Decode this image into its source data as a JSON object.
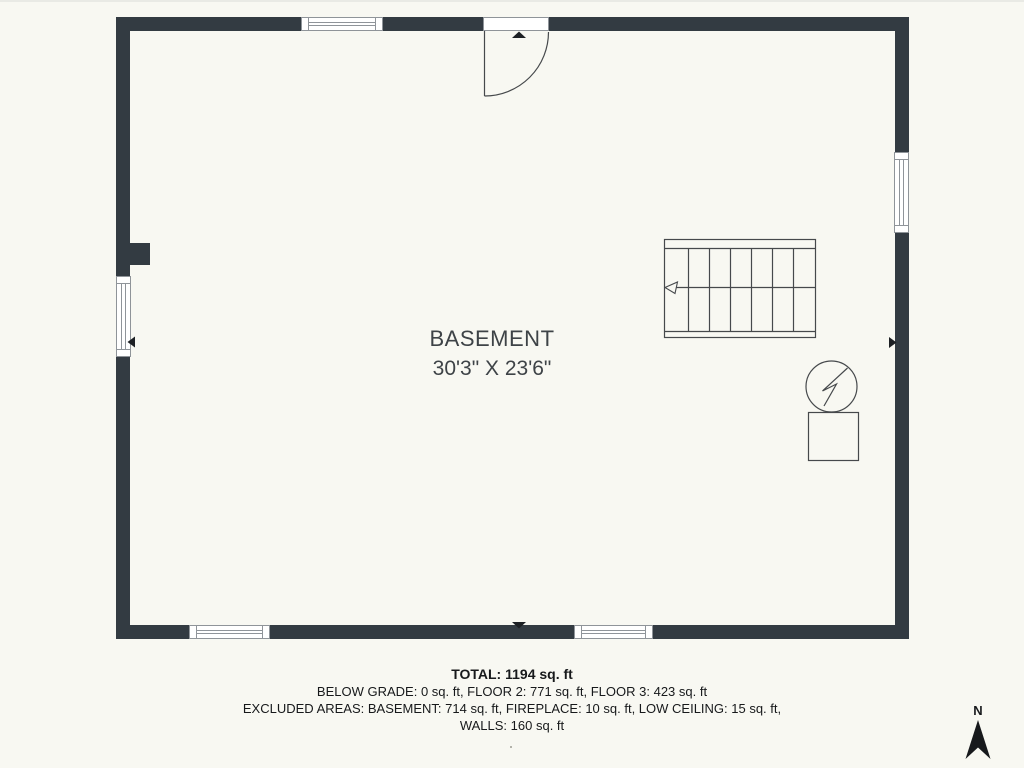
{
  "colors": {
    "bg": "#f8f8f2",
    "wall": "#333b42",
    "line": "#46494c",
    "winline": "#8f9499",
    "marker": "#1d2024",
    "roomtext": "#3e4347",
    "summarytext": "#17191b",
    "compass": "#17191c"
  },
  "room": {
    "name": "BASEMENT",
    "dimensions": "30'3\" X 23'6\""
  },
  "summary": {
    "total": "TOTAL: 1194 sq. ft",
    "below_grade_line": "BELOW GRADE: 0 sq. ft, FLOOR 2: 771 sq. ft, FLOOR 3: 423 sq. ft",
    "excluded_line": "EXCLUDED AREAS: BASEMENT: 714 sq. ft, FIREPLACE: 10 sq. ft, LOW CEILING: 15 sq. ft,",
    "walls_line": "WALLS: 160 sq. ft"
  },
  "compass": {
    "label": "N"
  },
  "symbols": {
    "stairs": "staircase-with-down-arrow",
    "utility": "utility-circle-lightning",
    "door": "quarter-swing-entry-door"
  }
}
